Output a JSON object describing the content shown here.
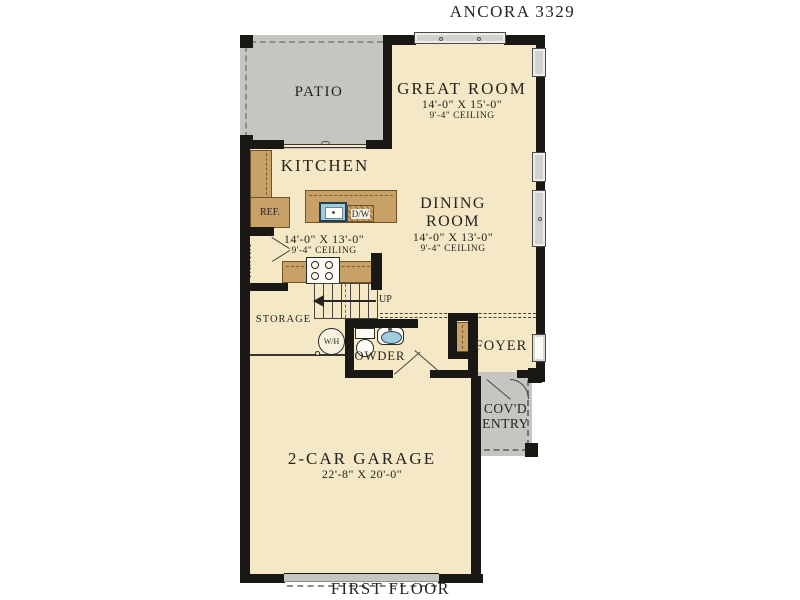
{
  "title": "ANCORA 3329",
  "footer": "FIRST FLOOR",
  "colors": {
    "floor": "#f4e8c6",
    "porch_gray": "#c6c5bf",
    "wall_black": "#191815",
    "cabinet_brown": "#c8a169",
    "sink_blue": "#9fccdf",
    "text": "#26241f"
  },
  "rooms": {
    "patio": {
      "label": "PATIO"
    },
    "great_room": {
      "label": "GREAT ROOM",
      "dims": "14'-0\" X 15'-0\"",
      "ceiling": "9'-4\" CEILING"
    },
    "kitchen": {
      "label": "KITCHEN",
      "dims": "14'-0\" X 13'-0\"",
      "ceiling": "9'-4\" CEILING"
    },
    "dining_room": {
      "line1": "DINING",
      "line2": "ROOM",
      "dims": "14'-0\" X 13'-0\"",
      "ceiling": "9'-4\" CEILING"
    },
    "storage": {
      "label": "STORAGE"
    },
    "powder": {
      "label": "POWDER"
    },
    "foyer": {
      "label": "FOYER"
    },
    "covd_entry": {
      "line1": "COV'D",
      "line2": "ENTRY"
    },
    "garage": {
      "label": "2-CAR GARAGE",
      "dims": "22'-8\" X 20'-0\""
    }
  },
  "fixtures": {
    "refrigerator": "REF.",
    "pantry": "PANTRY",
    "dishwasher": "D/W",
    "water_heater": "W/H",
    "stairs_direction": "UP"
  }
}
